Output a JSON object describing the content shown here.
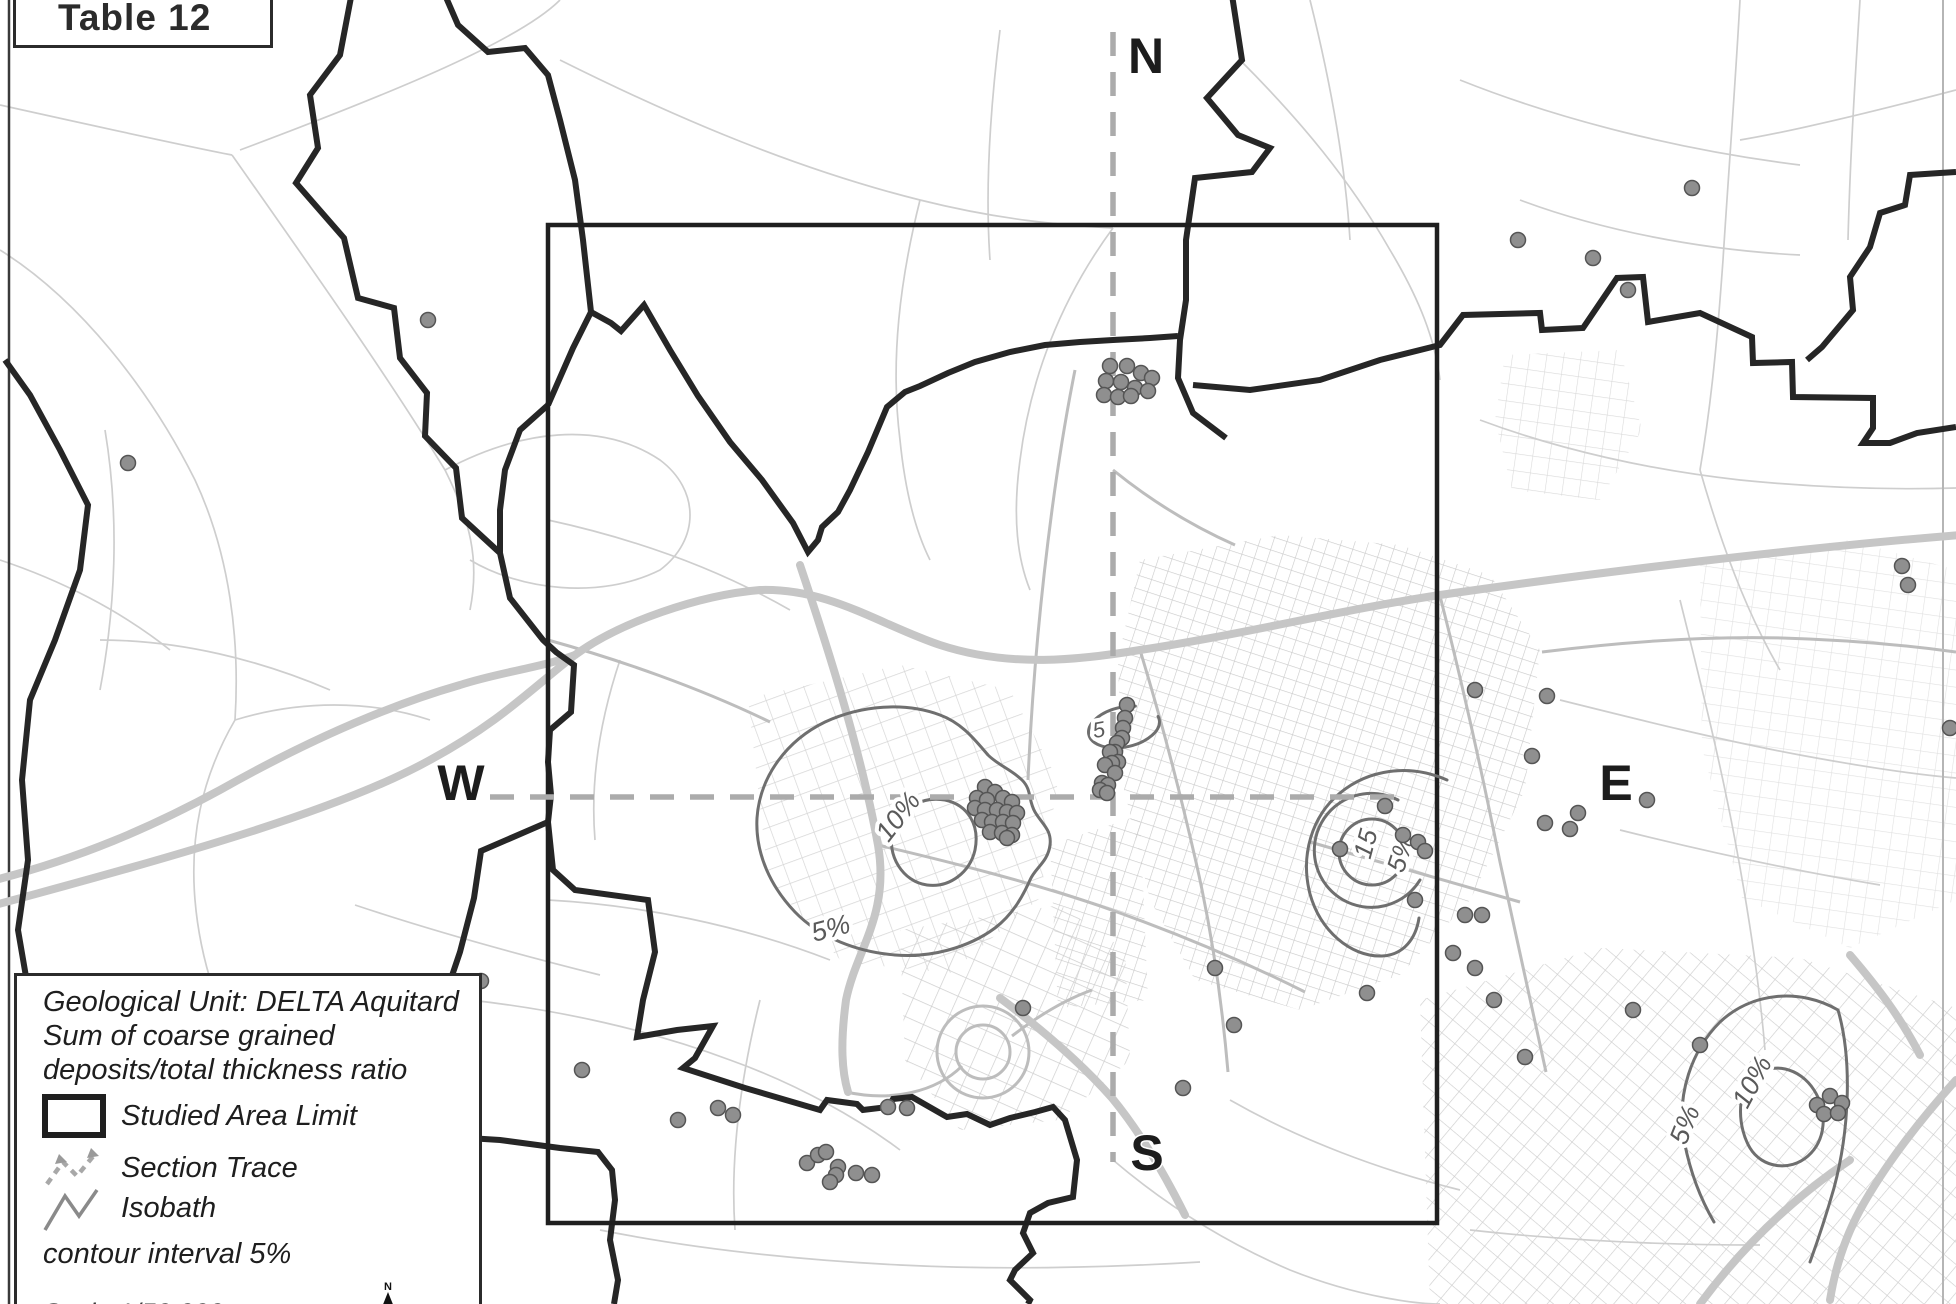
{
  "figure": {
    "title": "Table 12"
  },
  "legend": {
    "title_lines": [
      "Geological Unit: DELTA Aquitard",
      "Sum of coarse grained",
      "deposits/total thickness ratio"
    ],
    "items": [
      {
        "id": "studied-area-limit",
        "label": "Studied Area Limit"
      },
      {
        "id": "section-trace",
        "label": "Section Trace"
      },
      {
        "id": "isobath",
        "label": "Isobath"
      }
    ],
    "note": "contour interval 5%",
    "scale_label": "Scale 1/50 000",
    "north_arrow_label": "N"
  },
  "compass": {
    "north": "N",
    "south": "S",
    "west": "W",
    "east": "E"
  },
  "map": {
    "unit": "DELTA Aquitard",
    "contour_interval": "5%",
    "contour_labels": [
      {
        "text": "10%",
        "x": 905,
        "y": 822,
        "rot": -52,
        "size": 27
      },
      {
        "text": "5%",
        "x": 833,
        "y": 937,
        "rot": -15,
        "size": 27
      },
      {
        "text": "5",
        "x": 1100,
        "y": 737,
        "rot": -10,
        "size": 22
      },
      {
        "text": "15",
        "x": 1374,
        "y": 846,
        "rot": -75,
        "size": 26
      },
      {
        "text": "5%",
        "x": 1409,
        "y": 856,
        "rot": -72,
        "size": 26
      },
      {
        "text": "10%",
        "x": 1760,
        "y": 1086,
        "rot": -62,
        "size": 27
      },
      {
        "text": "5%",
        "x": 1693,
        "y": 1128,
        "rot": -68,
        "size": 27
      }
    ],
    "dots": [
      [
        428,
        320
      ],
      [
        128,
        463
      ],
      [
        481,
        981
      ],
      [
        582,
        1070
      ],
      [
        1692,
        188
      ],
      [
        1518,
        240
      ],
      [
        1593,
        258
      ],
      [
        1628,
        290
      ],
      [
        1902,
        566
      ],
      [
        1908,
        585
      ],
      [
        1950,
        728
      ],
      [
        1110,
        366
      ],
      [
        1127,
        366
      ],
      [
        1141,
        373
      ],
      [
        1152,
        378
      ],
      [
        1106,
        381
      ],
      [
        1121,
        382
      ],
      [
        1135,
        388
      ],
      [
        1148,
        391
      ],
      [
        1104,
        395
      ],
      [
        1118,
        397
      ],
      [
        1131,
        396
      ],
      [
        1127,
        705
      ],
      [
        1125,
        718
      ],
      [
        1123,
        728
      ],
      [
        1122,
        738
      ],
      [
        1117,
        743
      ],
      [
        1115,
        752
      ],
      [
        1110,
        752
      ],
      [
        1118,
        762
      ],
      [
        1112,
        763
      ],
      [
        1105,
        765
      ],
      [
        1115,
        773
      ],
      [
        1102,
        783
      ],
      [
        1108,
        785
      ],
      [
        1100,
        790
      ],
      [
        1107,
        793
      ],
      [
        985,
        787
      ],
      [
        995,
        792
      ],
      [
        977,
        798
      ],
      [
        987,
        800
      ],
      [
        1003,
        798
      ],
      [
        1012,
        802
      ],
      [
        975,
        808
      ],
      [
        985,
        810
      ],
      [
        997,
        810
      ],
      [
        1007,
        812
      ],
      [
        1017,
        813
      ],
      [
        982,
        820
      ],
      [
        992,
        822
      ],
      [
        1003,
        822
      ],
      [
        1013,
        823
      ],
      [
        990,
        832
      ],
      [
        1002,
        833
      ],
      [
        1012,
        835
      ],
      [
        1007,
        838
      ],
      [
        1340,
        849
      ],
      [
        1385,
        806
      ],
      [
        1403,
        835
      ],
      [
        1418,
        842
      ],
      [
        1425,
        851
      ],
      [
        1415,
        900
      ],
      [
        1465,
        915
      ],
      [
        1482,
        915
      ],
      [
        1453,
        953
      ],
      [
        1545,
        823
      ],
      [
        1475,
        690
      ],
      [
        1547,
        696
      ],
      [
        1532,
        756
      ],
      [
        1570,
        829
      ],
      [
        1647,
        800
      ],
      [
        1578,
        813
      ],
      [
        718,
        1108
      ],
      [
        733,
        1115
      ],
      [
        678,
        1120
      ],
      [
        807,
        1163
      ],
      [
        818,
        1155
      ],
      [
        826,
        1152
      ],
      [
        838,
        1167
      ],
      [
        836,
        1175
      ],
      [
        830,
        1182
      ],
      [
        856,
        1173
      ],
      [
        872,
        1175
      ],
      [
        888,
        1107
      ],
      [
        907,
        1108
      ],
      [
        1023,
        1008
      ],
      [
        1215,
        968
      ],
      [
        1234,
        1025
      ],
      [
        1183,
        1088
      ],
      [
        1367,
        993
      ],
      [
        1475,
        968
      ],
      [
        1494,
        1000
      ],
      [
        1525,
        1057
      ],
      [
        1817,
        1105
      ],
      [
        1830,
        1096
      ],
      [
        1842,
        1103
      ],
      [
        1824,
        1114
      ],
      [
        1838,
        1113
      ],
      [
        1633,
        1010
      ],
      [
        1700,
        1045
      ]
    ]
  },
  "colors": {
    "boundary": "#262626",
    "studied_area": "#1f1f1f",
    "contour": "#6f6f6f",
    "contour_label": "#5a5a5a",
    "section_trace": "#ababab",
    "road_light": "#cecece",
    "road_medium": "#bdbdbd",
    "road_wide": "#c6c6c6",
    "dot_fill": "#8f8f8f",
    "dot_stroke": "#555555"
  }
}
